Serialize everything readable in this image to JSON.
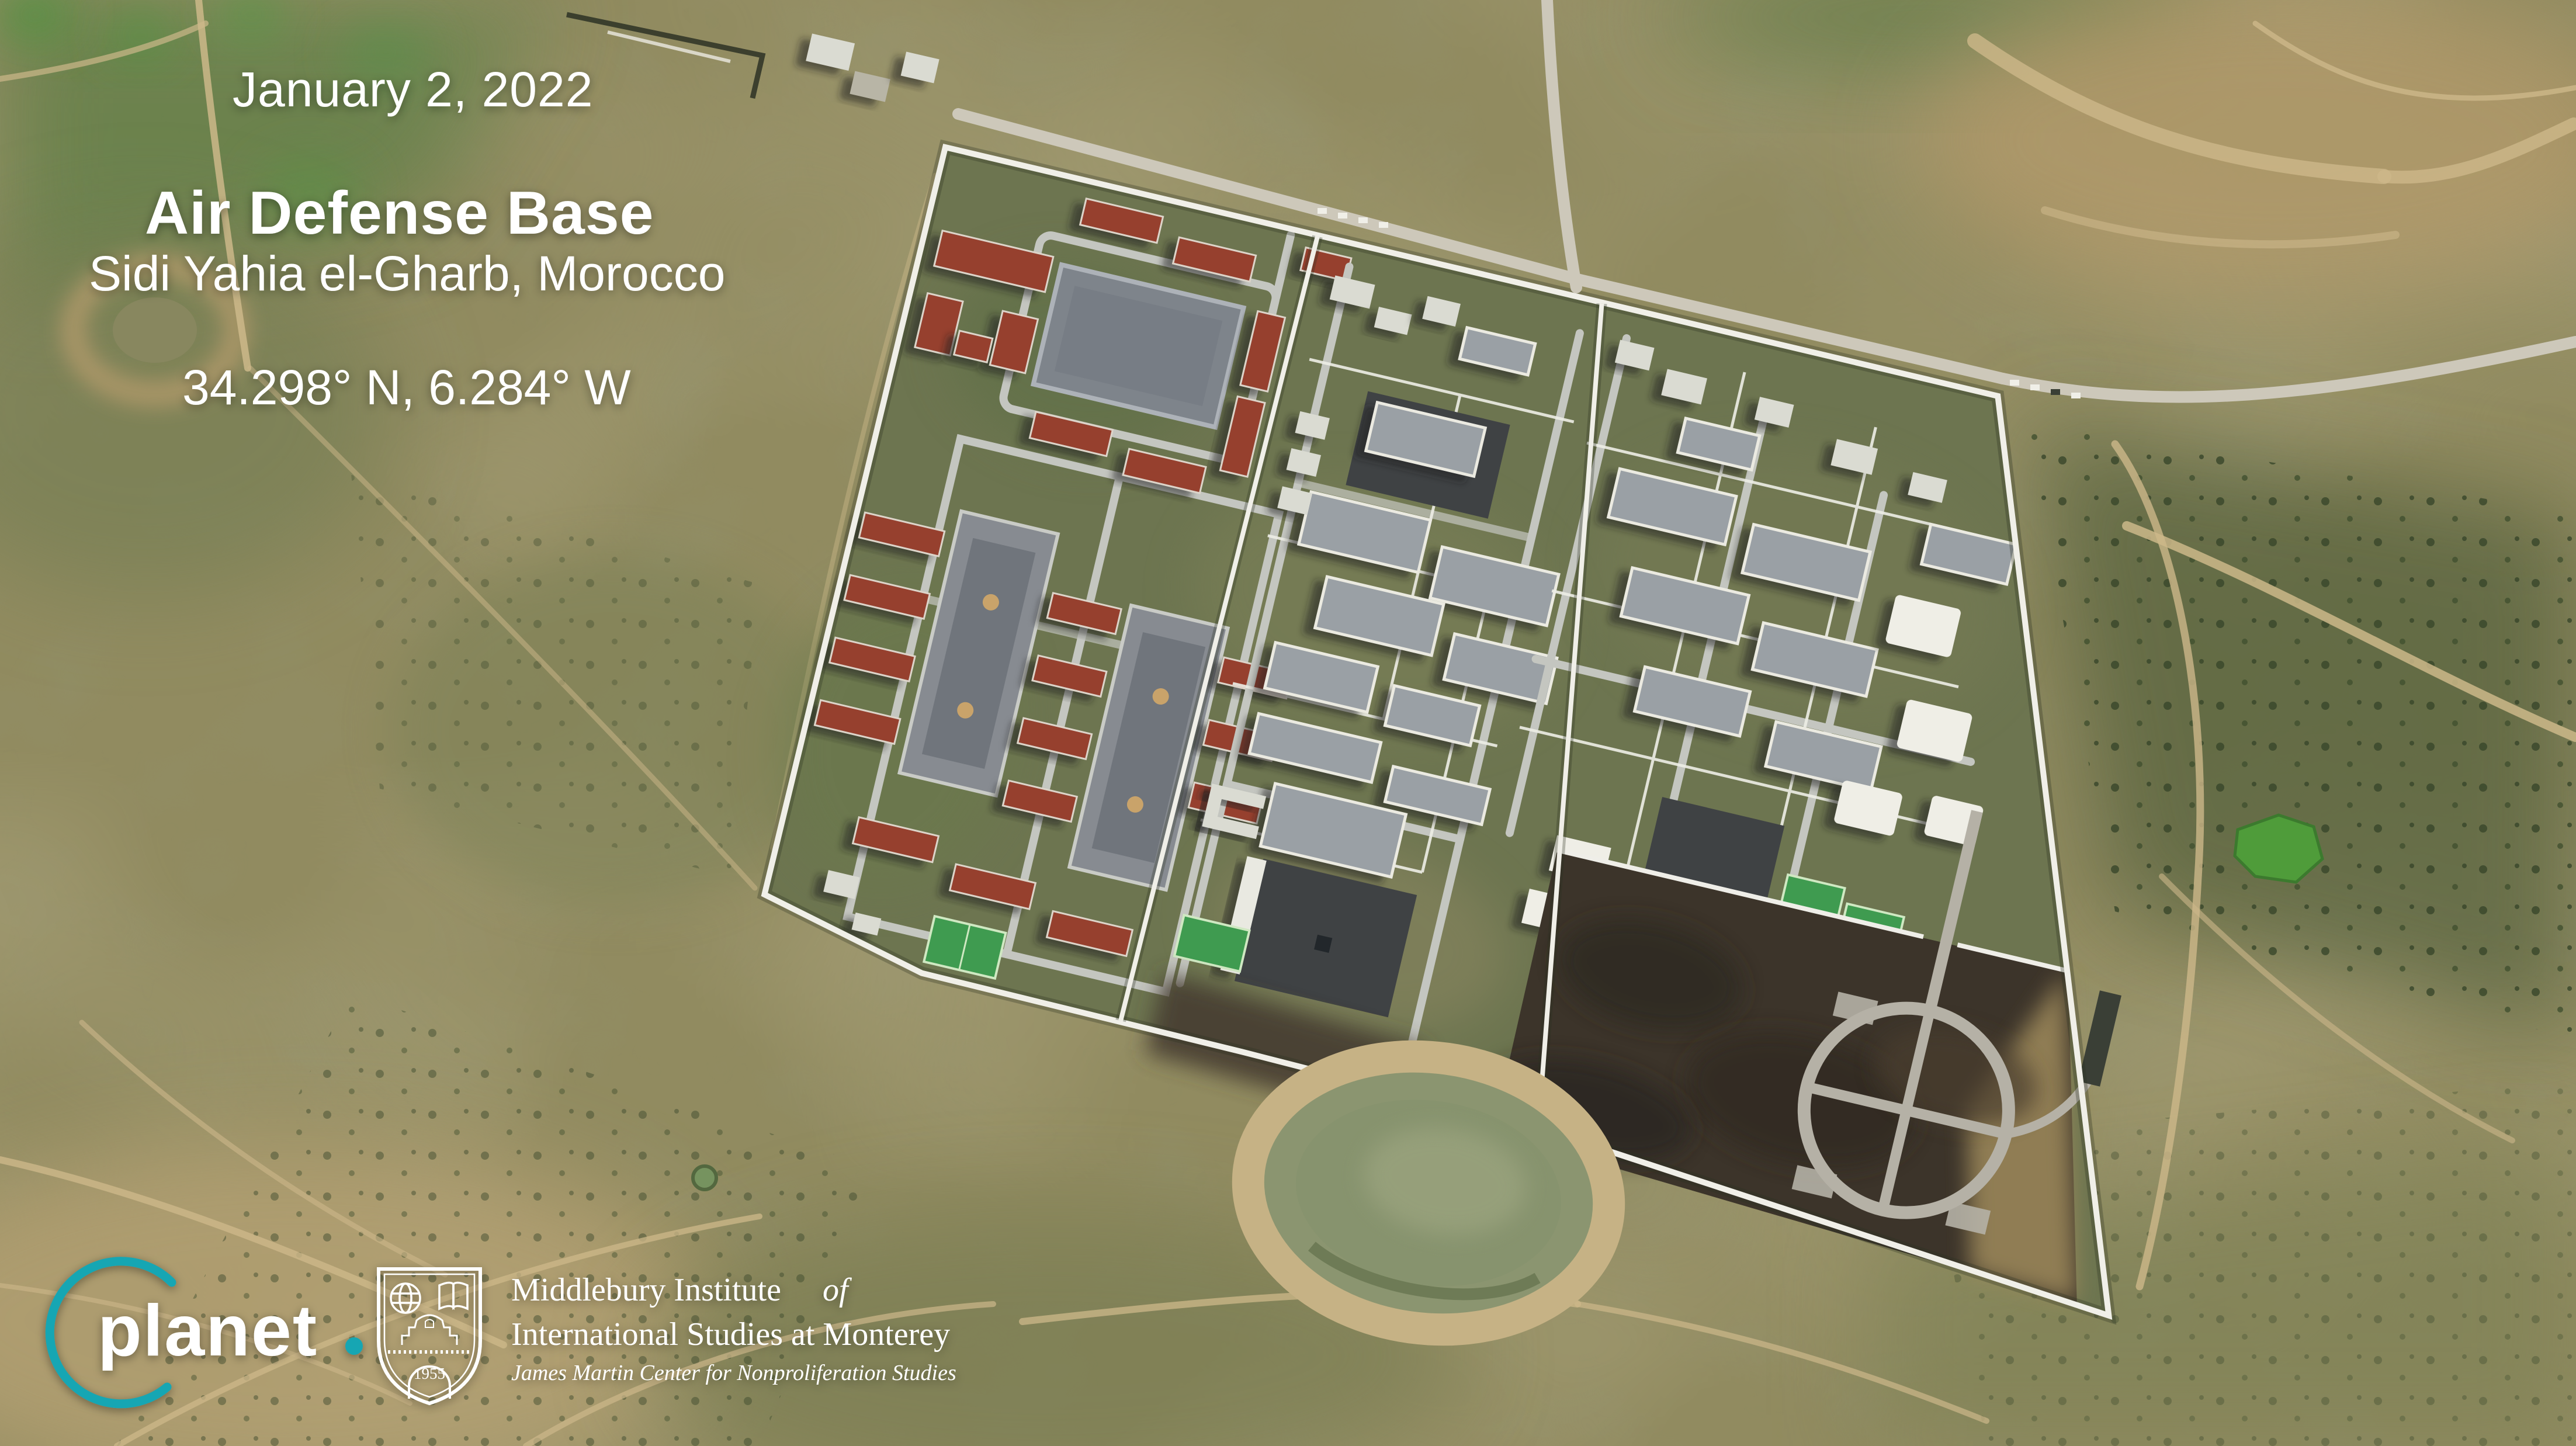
{
  "overlay": {
    "date": "January 2, 2022",
    "title": "Air Defense Base",
    "location": "Sidi Yahia el-Gharb, Morocco",
    "coordinates": "34.298° N, 6.284° W"
  },
  "branding": {
    "planet": {
      "wordmark": "planet",
      "accent_color": "#17a6b3"
    },
    "institute": {
      "line1": "Middlebury Institute",
      "line1_italic": "of",
      "line2": "International Studies at Monterey",
      "line3": "James Martin Center for Nonproliferation Studies",
      "shield_year": "1955"
    }
  }
}
